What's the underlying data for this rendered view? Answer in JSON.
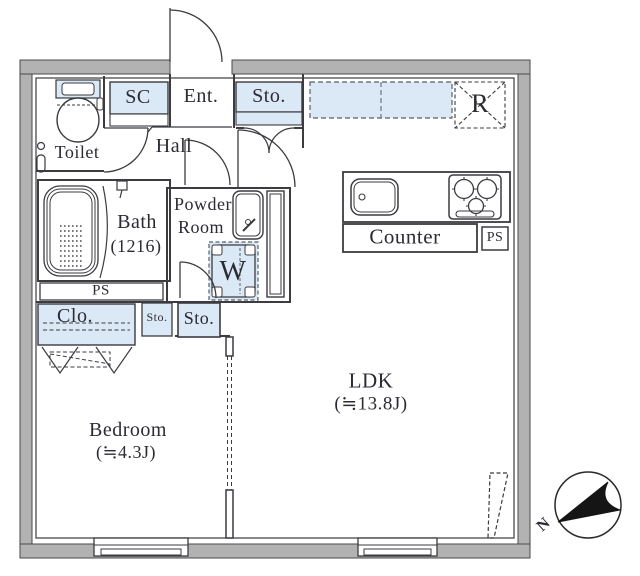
{
  "floor_plan": {
    "rooms": {
      "toilet": {
        "label": "Toilet"
      },
      "shoe_closet": {
        "label": "SC"
      },
      "entrance": {
        "label": "Ent."
      },
      "entrance_storage": {
        "label": "Sto."
      },
      "refrigerator_space": {
        "label": "R"
      },
      "hall": {
        "label": "Hall"
      },
      "bath": {
        "label": "Bath",
        "size_note": "(1216)"
      },
      "powder_room": {
        "label_line1": "Powder",
        "label_line2": "Room"
      },
      "washer_space": {
        "label": "W"
      },
      "pipe_space_bath": {
        "label": "PS"
      },
      "counter": {
        "label": "Counter"
      },
      "pipe_space_kitchen": {
        "label": "PS"
      },
      "closet": {
        "label": "Clo."
      },
      "storage_small": {
        "label": "Sto."
      },
      "storage_mid": {
        "label": "Sto."
      },
      "bedroom": {
        "label": "Bedroom",
        "area": "(≒4.3J)"
      },
      "ldk": {
        "label": "LDK",
        "area": "(≒13.8J)"
      }
    },
    "compass": {
      "north_label": "N"
    },
    "colors": {
      "wall_fill": "#b2b2b2",
      "wall_stroke": "#4a4a4a",
      "fixture_blue": "#dbe8f5",
      "line": "#3b3b40",
      "text": "#2b2b34"
    }
  }
}
